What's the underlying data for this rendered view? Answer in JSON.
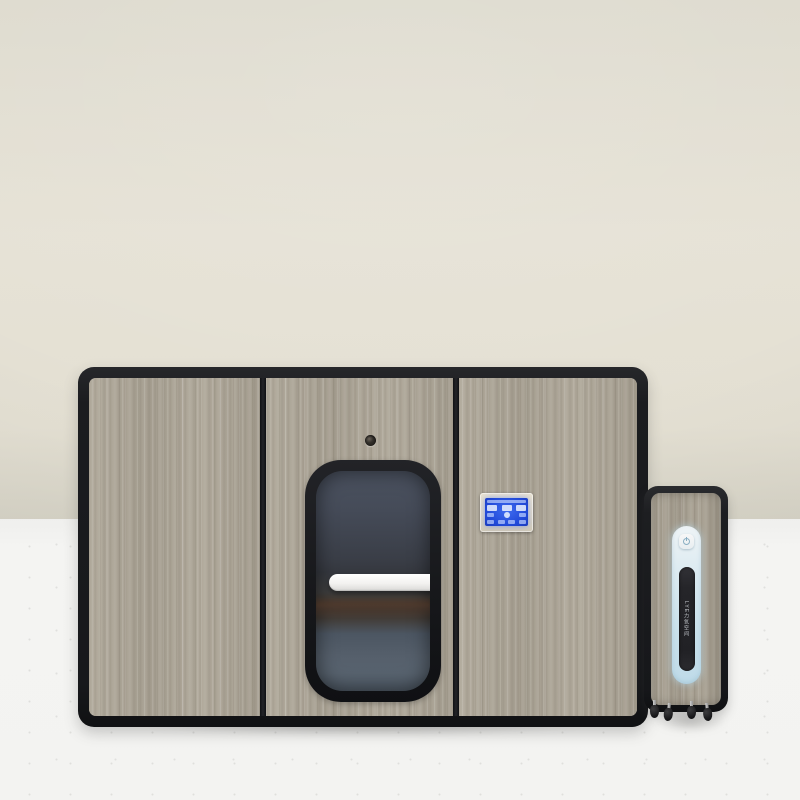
{
  "scene": {
    "type": "product-photo",
    "subject": "Wood-grain wellness cabin (oxygen chamber booth) with glass door and external wheeled concentrator unit",
    "wall_color": "#e4e0d4",
    "floor_color": "#f3f3f1"
  },
  "cabin": {
    "frame_color": "#17181b",
    "wood_color": "#ada597",
    "panel_count": 3,
    "peephole": "camera-peephole above door window",
    "door": {
      "window_glass_color": "#3f4550",
      "reflection": "lake horizon reflected in dark glass",
      "handle_color": "#f3f2f0"
    },
    "control_panel": {
      "bezel_color": "#ddd6c5",
      "screen_color": "#2149d8",
      "screen_content": "illegible blue LCD with status bar, three readout boxes, center dial and four small buttons"
    }
  },
  "side_unit": {
    "frame_color": "#1d1e21",
    "capsule_color": "#d8ecf5",
    "power_icon": "power-circle-bar",
    "label": "LYE力氧空间",
    "caster_count": 4
  }
}
